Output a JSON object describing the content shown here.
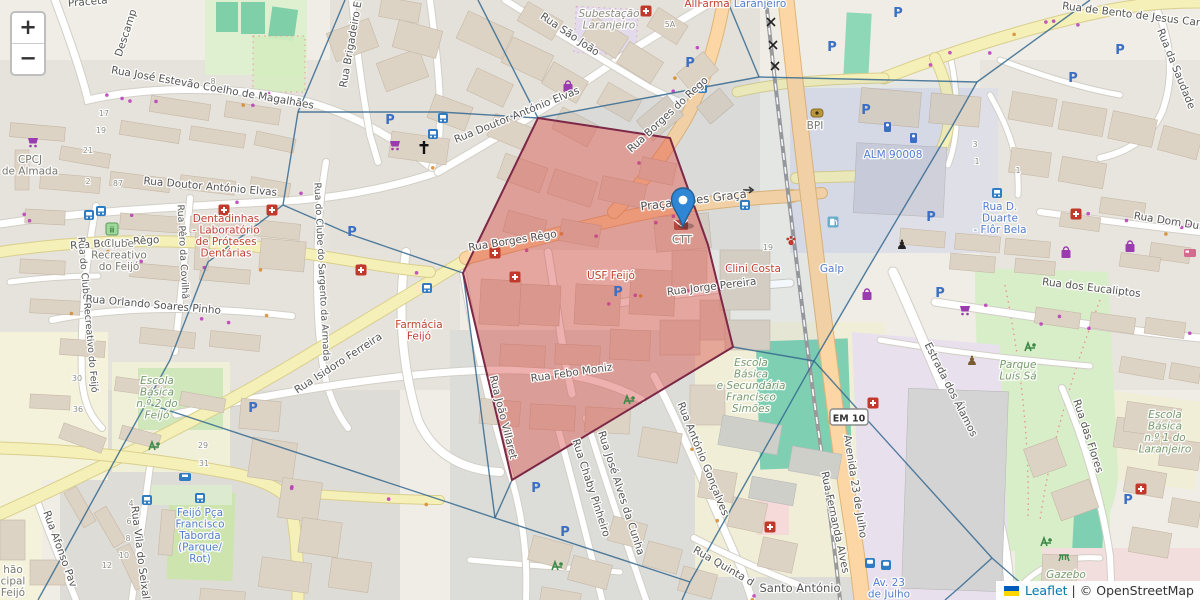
{
  "map": {
    "controls": {
      "zoom_in": "+",
      "zoom_out": "−"
    },
    "attribution": {
      "leaflet": "Leaflet",
      "separator": "|",
      "osm": "© OpenStreetMap",
      "flag_icon": "ukraine-flag-icon"
    },
    "marker": {
      "icon": "map-marker-icon",
      "x": 683,
      "y": 228,
      "color": "#2f86d4"
    },
    "colors": {
      "overlay_fill": "rgba(214,69,65,0.42)",
      "overlay_stroke": "#7c2847",
      "boundary_blue": "#35688f",
      "road_orange": "#fcd6a4",
      "road_yellow": "#f5f0b8",
      "poi_red": "#c0392b",
      "poi_blue": "#4d79cc",
      "poi_green": "#739768",
      "parking_blue": "#3b6fc4"
    },
    "overlay_polygon": [
      [
        538,
        118
      ],
      [
        670,
        138
      ],
      [
        708,
        245
      ],
      [
        733,
        347
      ],
      [
        512,
        480
      ],
      [
        463,
        273
      ]
    ],
    "boundary_lines": [
      [
        [
          345,
          0
        ],
        [
          298,
          112
        ],
        [
          283,
          205
        ],
        [
          208,
          262
        ],
        [
          170,
          360
        ],
        [
          38,
          600
        ]
      ],
      [
        [
          298,
          112
        ],
        [
          440,
          112
        ],
        [
          538,
          118
        ]
      ],
      [
        [
          478,
          0
        ],
        [
          538,
          118
        ]
      ],
      [
        [
          283,
          205
        ],
        [
          352,
          235
        ],
        [
          463,
          273
        ]
      ],
      [
        [
          538,
          118
        ],
        [
          759,
          77
        ]
      ],
      [
        [
          759,
          77
        ],
        [
          727,
          0
        ]
      ],
      [
        [
          759,
          77
        ],
        [
          977,
          82
        ]
      ],
      [
        [
          977,
          82
        ],
        [
          1090,
          0
        ]
      ],
      [
        [
          977,
          82
        ],
        [
          950,
          130
        ],
        [
          867,
          270
        ],
        [
          814,
          361
        ],
        [
          690,
          582
        ],
        [
          682,
          600
        ]
      ],
      [
        [
          814,
          361
        ],
        [
          992,
          558
        ]
      ],
      [
        [
          992,
          558
        ],
        [
          960,
          587
        ],
        [
          945,
          600
        ]
      ],
      [
        [
          992,
          558
        ],
        [
          1040,
          600
        ]
      ],
      [
        [
          495,
          518
        ],
        [
          450,
          503
        ],
        [
          146,
          403
        ]
      ],
      [
        [
          495,
          518
        ],
        [
          690,
          582
        ]
      ],
      [
        [
          463,
          273
        ],
        [
          495,
          518
        ]
      ],
      [
        [
          463,
          273
        ],
        [
          538,
          118
        ]
      ],
      [
        [
          733,
          347
        ],
        [
          814,
          361
        ]
      ],
      [
        [
          512,
          480
        ],
        [
          495,
          518
        ]
      ]
    ],
    "street_labels": [
      {
        "t": "Praceta",
        "x": 88,
        "y": 5,
        "r": -5
      },
      {
        "t": "Descamp",
        "x": 129,
        "y": 34,
        "r": -72
      },
      {
        "t": "Rua José Estevão Coelho de Magalhães",
        "x": 212,
        "y": 91,
        "r": 10
      },
      {
        "t": "Rua Doutor António Elvas",
        "x": 210,
        "y": 190,
        "r": 5
      },
      {
        "t": "Rua Doutor António Elvas",
        "x": 518,
        "y": 118,
        "r": -22
      },
      {
        "t": "Rua São João",
        "x": 568,
        "y": 37,
        "r": 34
      },
      {
        "t": "Rua Brigadeiro E",
        "x": 354,
        "y": 45,
        "r": -80
      },
      {
        "t": "Rua de Bento de Jesus Cara",
        "x": 1134,
        "y": 18,
        "r": 7
      },
      {
        "t": "Rua da Saudade",
        "x": 1173,
        "y": 70,
        "r": 68
      },
      {
        "t": "Rua Borges do Rego",
        "x": 670,
        "y": 117,
        "r": -43
      },
      {
        "t": "Praça Lopes Graça",
        "x": 694,
        "y": 204,
        "r": -7,
        "big": true
      },
      {
        "t": "Rua Borges Rêgo",
        "x": 115,
        "y": 246,
        "r": -4
      },
      {
        "t": "Rua Borges Rêgo",
        "x": 513,
        "y": 244,
        "r": -9
      },
      {
        "t": "Rua Isidoro Ferreira",
        "x": 340,
        "y": 366,
        "r": -33
      },
      {
        "t": "Rua Febo Moniz",
        "x": 572,
        "y": 376,
        "r": -8
      },
      {
        "t": "Rua Jorge Pereira",
        "x": 712,
        "y": 290,
        "r": -7
      },
      {
        "t": "Rua João Villaret",
        "x": 500,
        "y": 418,
        "r": 76
      },
      {
        "t": "Rua Chaby Pinheiro",
        "x": 588,
        "y": 489,
        "r": 72
      },
      {
        "t": "Rua José Alves da Cunha",
        "x": 618,
        "y": 494,
        "r": 72
      },
      {
        "t": "Rua António Gonçalves",
        "x": 700,
        "y": 460,
        "r": 68
      },
      {
        "t": "Rua Quinta d",
        "x": 722,
        "y": 569,
        "r": 30
      },
      {
        "t": "Rua Fernanda Alves",
        "x": 832,
        "y": 523,
        "r": 78
      },
      {
        "t": "Avenida 23 de Julho",
        "x": 852,
        "y": 487,
        "r": 81
      },
      {
        "t": "Estrada dos Álamos",
        "x": 948,
        "y": 391,
        "r": 63
      },
      {
        "t": "Rua dos Eucaliptos",
        "x": 1091,
        "y": 291,
        "r": 7
      },
      {
        "t": "Rua Dom Du",
        "x": 1166,
        "y": 224,
        "r": 9
      },
      {
        "t": "Santo António",
        "x": 800,
        "y": 592,
        "r": 0,
        "big": true
      },
      {
        "t": "Rua Vila do Seixal",
        "x": 137,
        "y": 553,
        "r": 83
      },
      {
        "t": "Rua Afonso Pav",
        "x": 57,
        "y": 550,
        "r": 70
      },
      {
        "t": "Rua das Flores",
        "x": 1085,
        "y": 437,
        "r": 72
      },
      {
        "t": "Rua do Clube Recreativo do Feijó",
        "x": 85,
        "y": 315,
        "r": 85,
        "sm": true
      },
      {
        "t": "Rua do Clube do Sargento da Armada",
        "x": 319,
        "y": 272,
        "r": 87,
        "sm": true
      },
      {
        "t": "Rua Pêro da Covilhã",
        "x": 180,
        "y": 252,
        "r": 87,
        "sm": true
      },
      {
        "t": "Rua Orlando Soares Pinho",
        "x": 153,
        "y": 308,
        "r": 5
      }
    ],
    "poi_labels": [
      {
        "t": "AllFarma",
        "x": 707,
        "y": 7,
        "cls": "poi-red"
      },
      {
        "t": "Laranjeiro",
        "x": 760,
        "y": 7,
        "cls": "poi-blue"
      },
      {
        "t": "Subestação\nLaranjeiro",
        "x": 609,
        "y": 17,
        "cls": "poi-greyi"
      },
      {
        "t": "USF Feijó",
        "x": 611,
        "y": 279,
        "cls": "poi-red"
      },
      {
        "t": "Farmácia\nFeijó",
        "x": 419,
        "y": 328,
        "cls": "poi-red"
      },
      {
        "t": "Dentadinhas\n- Laboratório\nde Próteses\nDentárias",
        "x": 226,
        "y": 222,
        "cls": "poi-red"
      },
      {
        "t": "Clini Costa",
        "x": 753,
        "y": 272,
        "cls": "poi-red"
      },
      {
        "t": "Clube\nRecreativo\ndo Feijó",
        "x": 119,
        "y": 247,
        "cls": "poi-grey"
      },
      {
        "t": "CPCJ\nde Almada",
        "x": 30,
        "y": 163,
        "cls": "poi-grey"
      },
      {
        "t": "CTT",
        "x": 682,
        "y": 243,
        "cls": "poi-grey"
      },
      {
        "t": "BPI",
        "x": 815,
        "y": 129,
        "cls": "poi-grey"
      },
      {
        "t": "hão\ncipal\nFeijó",
        "x": 13,
        "y": 573,
        "cls": "poi-grey"
      },
      {
        "t": "Feijó Pça\nFrancisco\nTaborda\n(Parque/\nRot)",
        "x": 200,
        "y": 516,
        "cls": "poi-blue"
      },
      {
        "t": "Rua D.\nDuarte\n- Flôr Bela",
        "x": 1000,
        "y": 210,
        "cls": "poi-blue"
      },
      {
        "t": "ALM 90008",
        "x": 893,
        "y": 158,
        "cls": "poi-blue"
      },
      {
        "t": "Galp",
        "x": 832,
        "y": 272,
        "cls": "poi-blue"
      },
      {
        "t": "Av. 23\nde Julho",
        "x": 889,
        "y": 586,
        "cls": "poi-blue"
      },
      {
        "t": "Escola\nBásica\nn.º 2 do\nFeijó",
        "x": 157,
        "y": 384,
        "cls": "poi-green"
      },
      {
        "t": "Escola\nBásica\ne Secundária\nFrancisco\nSimões",
        "x": 751,
        "y": 366,
        "cls": "poi-green"
      },
      {
        "t": "Parque\nLuís Sá",
        "x": 1018,
        "y": 368,
        "cls": "poi-green"
      },
      {
        "t": "Gazebo",
        "x": 1066,
        "y": 578,
        "cls": "poi-green"
      },
      {
        "t": "Escola\nBásica\nn.º 1 do\nLaranjeiro",
        "x": 1165,
        "y": 418,
        "cls": "poi-green"
      }
    ],
    "ref_badge": {
      "t": "EM 10",
      "x": 849,
      "y": 418
    },
    "house_numbers": [
      {
        "t": "17",
        "x": 104,
        "y": 116
      },
      {
        "t": "19",
        "x": 101,
        "y": 133
      },
      {
        "t": "21",
        "x": 88,
        "y": 153
      },
      {
        "t": "87",
        "x": 118,
        "y": 186
      },
      {
        "t": "2",
        "x": 88,
        "y": 184
      },
      {
        "t": "8",
        "x": 213,
        "y": 84
      },
      {
        "t": "5A",
        "x": 670,
        "y": 27
      },
      {
        "t": "30",
        "x": 77,
        "y": 381
      },
      {
        "t": "36",
        "x": 78,
        "y": 412
      },
      {
        "t": "29",
        "x": 203,
        "y": 448
      },
      {
        "t": "31",
        "x": 204,
        "y": 466
      },
      {
        "t": "4",
        "x": 131,
        "y": 506
      },
      {
        "t": "6",
        "x": 129,
        "y": 524
      },
      {
        "t": "8",
        "x": 128,
        "y": 541
      },
      {
        "t": "10",
        "x": 124,
        "y": 558
      },
      {
        "t": "12",
        "x": 107,
        "y": 568
      },
      {
        "t": "3",
        "x": 975,
        "y": 147
      },
      {
        "t": "1",
        "x": 977,
        "y": 164
      },
      {
        "t": "1",
        "x": 1018,
        "y": 173
      },
      {
        "t": "19",
        "x": 768,
        "y": 250
      }
    ],
    "icons": [
      {
        "n": "church-icon",
        "x": 424,
        "y": 148
      },
      {
        "n": "hospital-cross-icon",
        "x": 224,
        "y": 210
      },
      {
        "n": "hospital-cross-icon",
        "x": 272,
        "y": 210
      },
      {
        "n": "hospital-cross-icon",
        "x": 646,
        "y": 11
      },
      {
        "n": "hospital-cross-icon",
        "x": 495,
        "y": 253
      },
      {
        "n": "hospital-cross-icon",
        "x": 515,
        "y": 277
      },
      {
        "n": "hospital-cross-icon",
        "x": 361,
        "y": 270
      },
      {
        "n": "hospital-cross-icon",
        "x": 1076,
        "y": 214
      },
      {
        "n": "hospital-cross-icon",
        "x": 770,
        "y": 527
      },
      {
        "n": "hospital-cross-icon",
        "x": 1141,
        "y": 489
      },
      {
        "n": "hospital-cross-icon",
        "x": 873,
        "y": 403
      },
      {
        "n": "vet-paw-icon",
        "x": 791,
        "y": 241
      },
      {
        "n": "parking-icon",
        "x": 390,
        "y": 120
      },
      {
        "n": "parking-icon",
        "x": 690,
        "y": 63
      },
      {
        "n": "parking-icon",
        "x": 898,
        "y": 13
      },
      {
        "n": "parking-icon",
        "x": 832,
        "y": 47
      },
      {
        "n": "parking-icon",
        "x": 866,
        "y": 110
      },
      {
        "n": "parking-icon",
        "x": 931,
        "y": 217
      },
      {
        "n": "parking-icon",
        "x": 1120,
        "y": 50
      },
      {
        "n": "parking-icon",
        "x": 1073,
        "y": 78
      },
      {
        "n": "parking-icon",
        "x": 253,
        "y": 408
      },
      {
        "n": "parking-icon",
        "x": 536,
        "y": 488
      },
      {
        "n": "parking-icon",
        "x": 565,
        "y": 532
      },
      {
        "n": "parking-icon",
        "x": 940,
        "y": 293
      },
      {
        "n": "parking-icon",
        "x": 1128,
        "y": 500
      },
      {
        "n": "parking-icon",
        "x": 352,
        "y": 232
      },
      {
        "n": "parking-icon",
        "x": 618,
        "y": 292
      },
      {
        "n": "parking-meter-icon",
        "x": 887,
        "y": 127
      },
      {
        "n": "parking-meter-icon",
        "x": 913,
        "y": 138
      },
      {
        "n": "bus-stop-icon",
        "x": 745,
        "y": 205
      },
      {
        "n": "bus-stop-icon",
        "x": 427,
        "y": 288
      },
      {
        "n": "bus-stop-icon",
        "x": 702,
        "y": 88
      },
      {
        "n": "bus-stop-icon",
        "x": 443,
        "y": 118
      },
      {
        "n": "bus-stop-icon",
        "x": 433,
        "y": 134
      },
      {
        "n": "bus-stop-icon",
        "x": 89,
        "y": 215
      },
      {
        "n": "bus-stop-icon",
        "x": 101,
        "y": 211
      },
      {
        "n": "bus-stop-icon",
        "x": 147,
        "y": 500
      },
      {
        "n": "bus-stop-icon",
        "x": 200,
        "y": 498
      },
      {
        "n": "bus-stop-icon",
        "x": 997,
        "y": 193
      },
      {
        "n": "taxi-icon",
        "x": 185,
        "y": 477
      },
      {
        "n": "train-station-icon",
        "x": 870,
        "y": 563
      },
      {
        "n": "train-station-icon",
        "x": 886,
        "y": 565
      },
      {
        "n": "shopping-cart-icon",
        "x": 33,
        "y": 142
      },
      {
        "n": "shopping-cart-icon",
        "x": 395,
        "y": 145
      },
      {
        "n": "shopping-cart-icon",
        "x": 965,
        "y": 310
      },
      {
        "n": "shopping-bag-icon",
        "x": 867,
        "y": 295
      },
      {
        "n": "shopping-bag-icon",
        "x": 1066,
        "y": 253
      },
      {
        "n": "shopping-bag-icon",
        "x": 1130,
        "y": 247
      },
      {
        "n": "shopping-bag-icon",
        "x": 568,
        "y": 87
      },
      {
        "n": "statue-icon",
        "x": 902,
        "y": 244
      },
      {
        "n": "statue-brown-icon",
        "x": 972,
        "y": 360
      },
      {
        "n": "playground-icon",
        "x": 557,
        "y": 566
      },
      {
        "n": "playground-icon",
        "x": 1046,
        "y": 542
      },
      {
        "n": "playground-icon",
        "x": 1030,
        "y": 347
      },
      {
        "n": "playground-icon",
        "x": 629,
        "y": 400
      },
      {
        "n": "playground-icon",
        "x": 154,
        "y": 446
      },
      {
        "n": "club-icon",
        "x": 112,
        "y": 229
      },
      {
        "n": "picnic-icon",
        "x": 1064,
        "y": 557
      },
      {
        "n": "bed-icon",
        "x": 1190,
        "y": 253
      },
      {
        "n": "bank-icon",
        "x": 817,
        "y": 113
      },
      {
        "n": "fuel-icon",
        "x": 833,
        "y": 222
      },
      {
        "n": "post-office-icon",
        "x": 681,
        "y": 225
      },
      {
        "n": "oneway-arrow-icon",
        "x": 748,
        "y": 190
      }
    ]
  }
}
